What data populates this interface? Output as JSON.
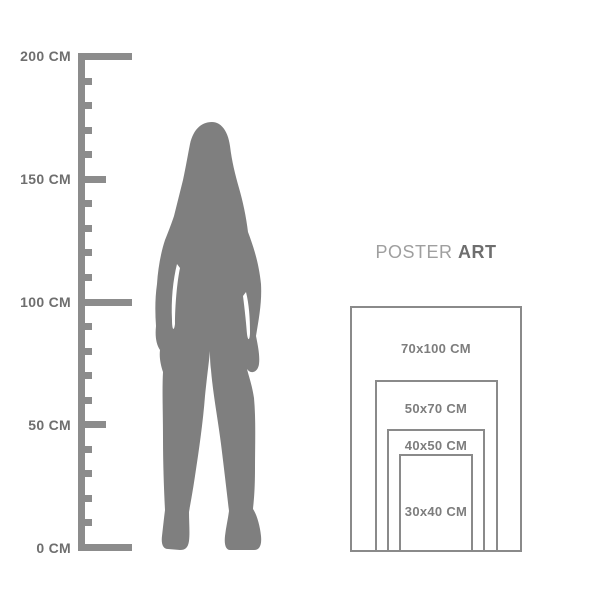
{
  "canvas": {
    "background": "#ffffff"
  },
  "colors": {
    "ruler": "#8c8c8c",
    "ruler_label_text": "#6e6e6e",
    "silhouette": "#7f7f7f",
    "heading_light": "#9f9f9f",
    "heading_bold": "#6e6e6e",
    "frame_border": "#8a8a8a",
    "frame_label_text": "#7d7d7d"
  },
  "ruler": {
    "unit": "CM",
    "min_cm": 0,
    "max_cm": 200,
    "step_cm": 10,
    "ticks": [
      {
        "cm": 0,
        "type": "major",
        "label": "0 CM"
      },
      {
        "cm": 10,
        "type": "minor"
      },
      {
        "cm": 20,
        "type": "minor"
      },
      {
        "cm": 30,
        "type": "minor"
      },
      {
        "cm": 40,
        "type": "minor"
      },
      {
        "cm": 50,
        "type": "mid",
        "label": "50 CM"
      },
      {
        "cm": 60,
        "type": "minor"
      },
      {
        "cm": 70,
        "type": "minor"
      },
      {
        "cm": 80,
        "type": "minor"
      },
      {
        "cm": 90,
        "type": "minor"
      },
      {
        "cm": 100,
        "type": "major",
        "label": "100 CM"
      },
      {
        "cm": 110,
        "type": "minor"
      },
      {
        "cm": 120,
        "type": "minor"
      },
      {
        "cm": 130,
        "type": "minor"
      },
      {
        "cm": 140,
        "type": "minor"
      },
      {
        "cm": 150,
        "type": "mid",
        "label": "150 CM"
      },
      {
        "cm": 160,
        "type": "minor"
      },
      {
        "cm": 170,
        "type": "minor"
      },
      {
        "cm": 180,
        "type": "minor"
      },
      {
        "cm": 190,
        "type": "minor"
      },
      {
        "cm": 200,
        "type": "major",
        "label": "200 CM"
      }
    ]
  },
  "silhouette": {
    "icon": "woman-silhouette",
    "fill": "#7f7f7f"
  },
  "heading": {
    "light": "POSTER",
    "bold": "ART"
  },
  "poster_sizes": [
    {
      "label": "70x100 CM",
      "w_cm": 70,
      "h_cm": 100
    },
    {
      "label": "50x70 CM",
      "w_cm": 50,
      "h_cm": 70
    },
    {
      "label": "40x50 CM",
      "w_cm": 40,
      "h_cm": 50
    },
    {
      "label": "30x40 CM",
      "w_cm": 30,
      "h_cm": 40
    }
  ]
}
